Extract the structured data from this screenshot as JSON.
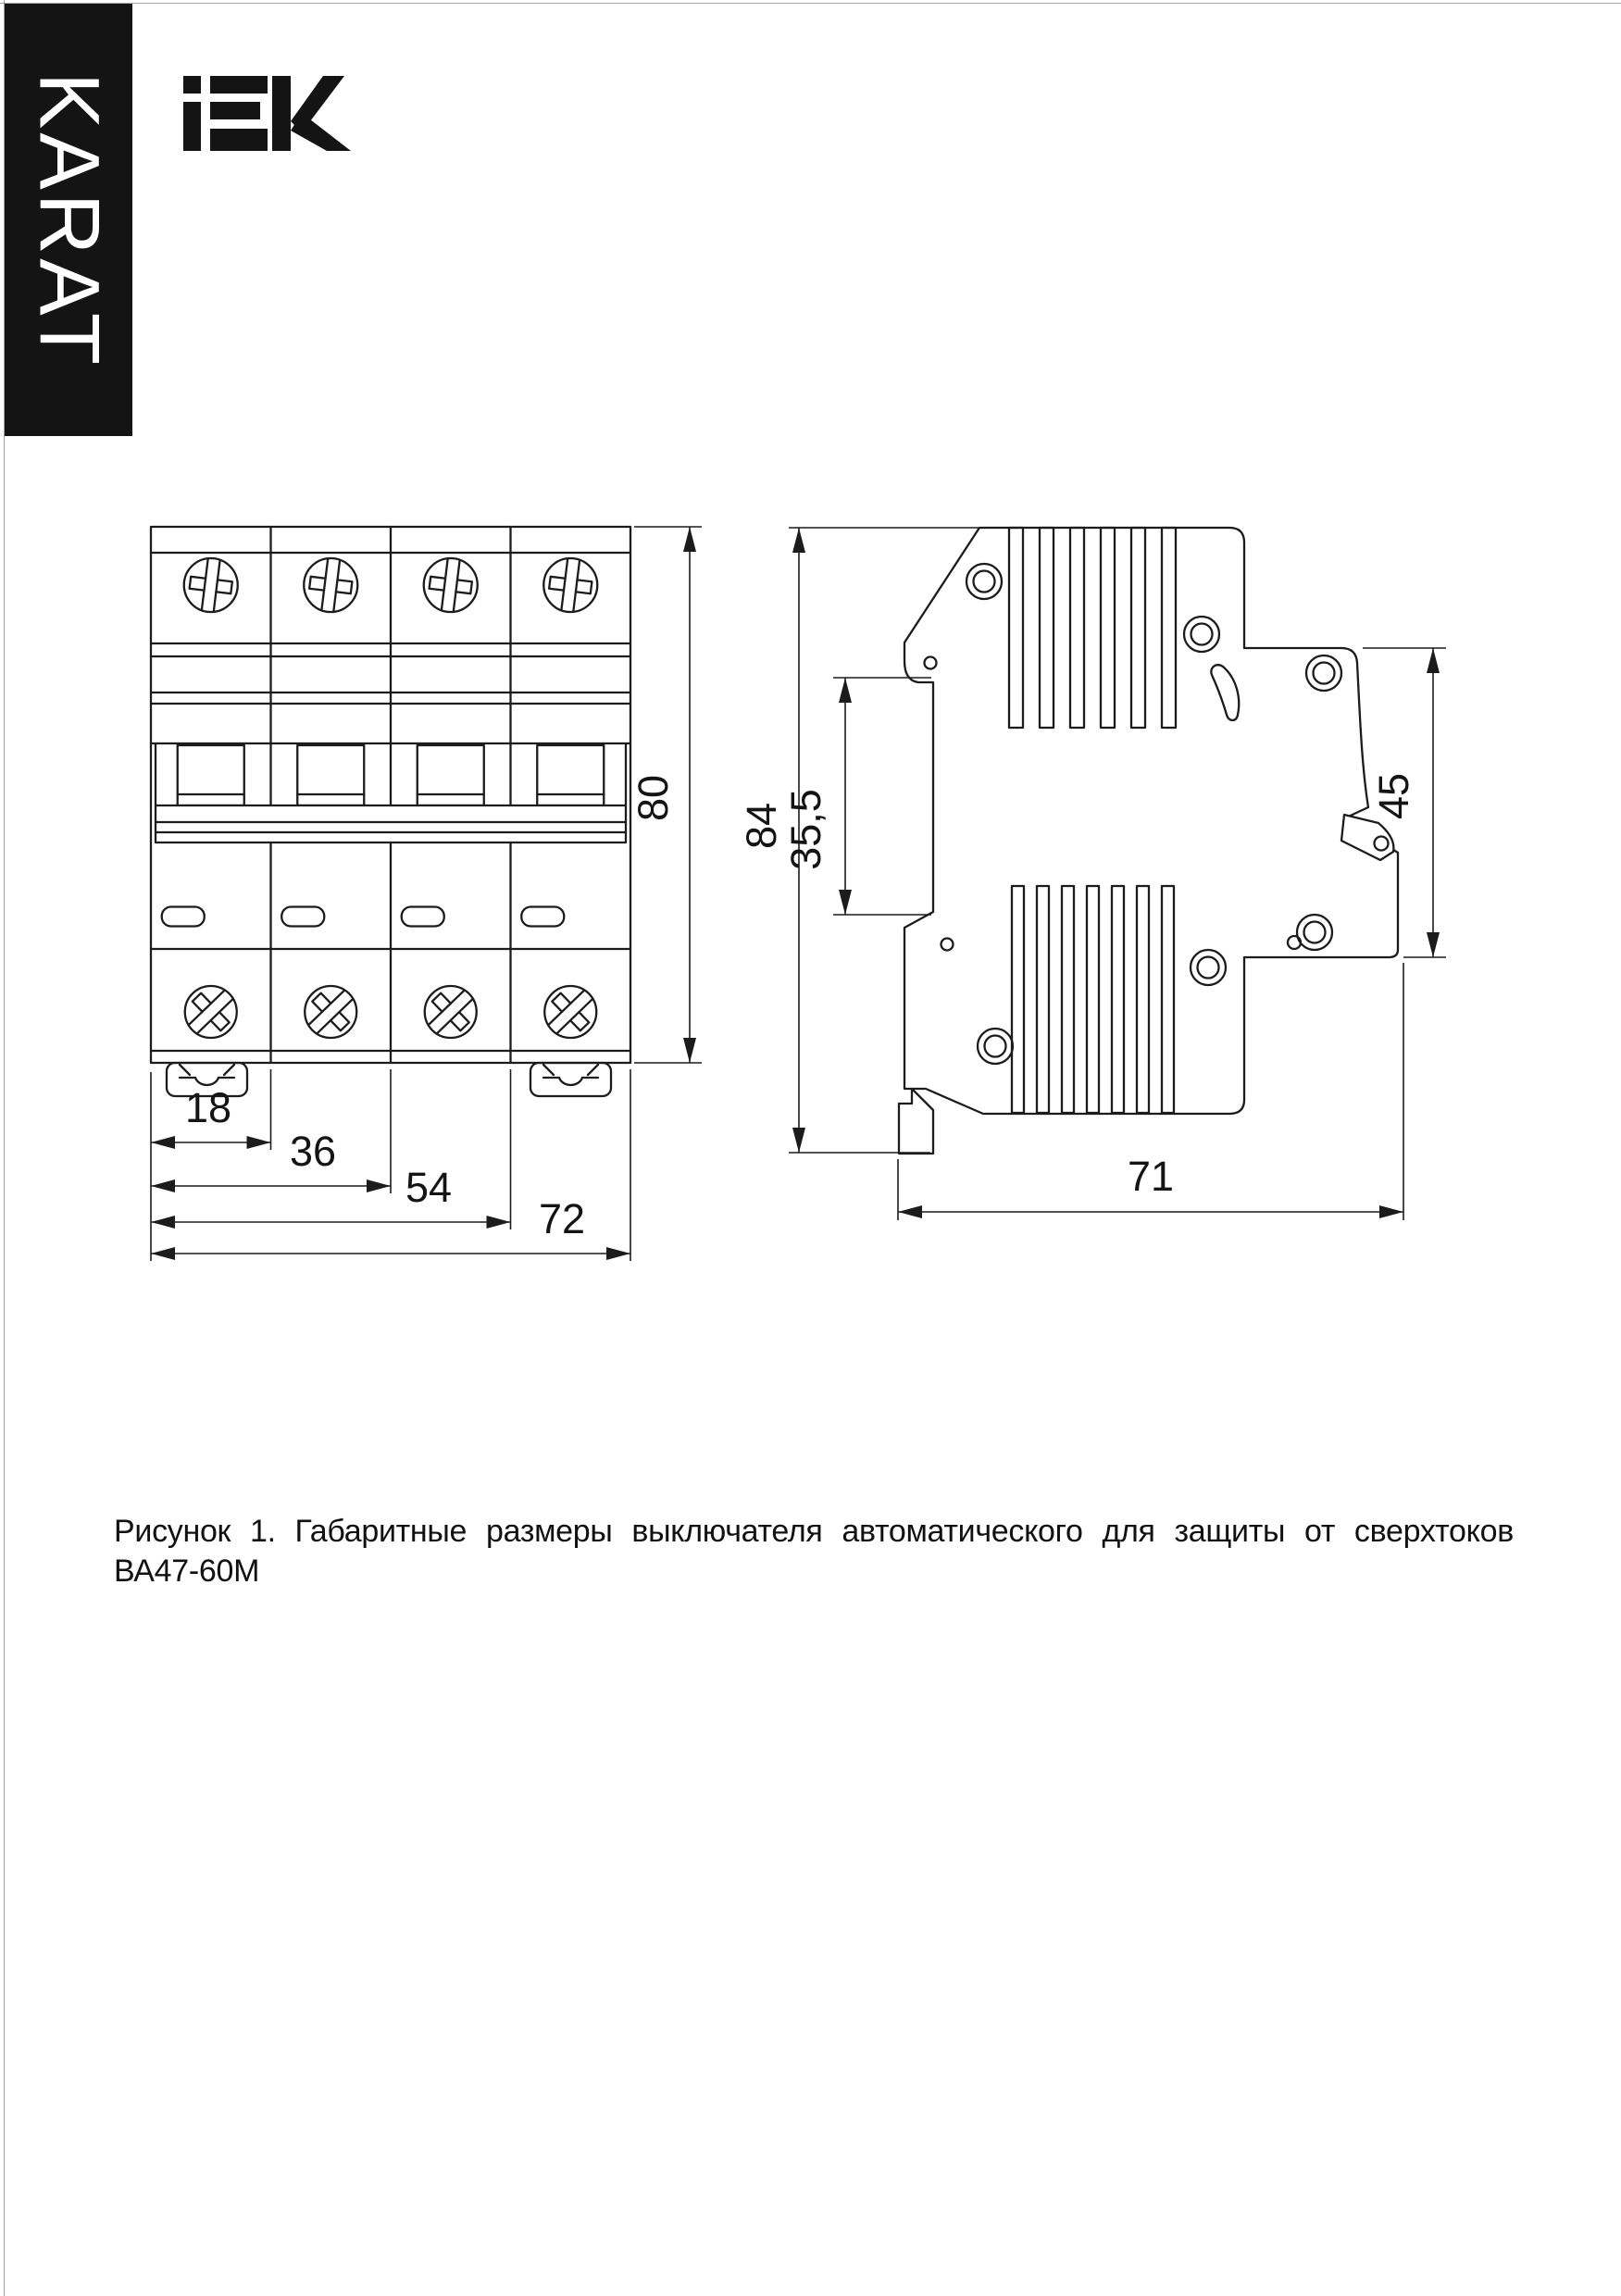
{
  "colors": {
    "paper": "#ffffff",
    "ink": "#1c1c1c",
    "brand_bar_bg": "#141414",
    "brand_bar_text": "#ffffff"
  },
  "brand": {
    "vertical_label": "KARAT",
    "logo_text": "IEK"
  },
  "figure": {
    "caption": "Рисунок 1. Габаритные размеры выключателя автоматического для защиты от сверхтоков ВА47-60М",
    "front_view": {
      "description": "front view of 4-pole circuit breaker",
      "dims": {
        "module_width": "18",
        "two_modules": "36",
        "three_modules": "54",
        "total_width": "72",
        "height": "80"
      }
    },
    "side_view": {
      "description": "side view of circuit breaker on DIN rail",
      "dims": {
        "total_height": "84",
        "din_recess": "35,5",
        "front_height": "45",
        "depth": "71"
      }
    }
  }
}
